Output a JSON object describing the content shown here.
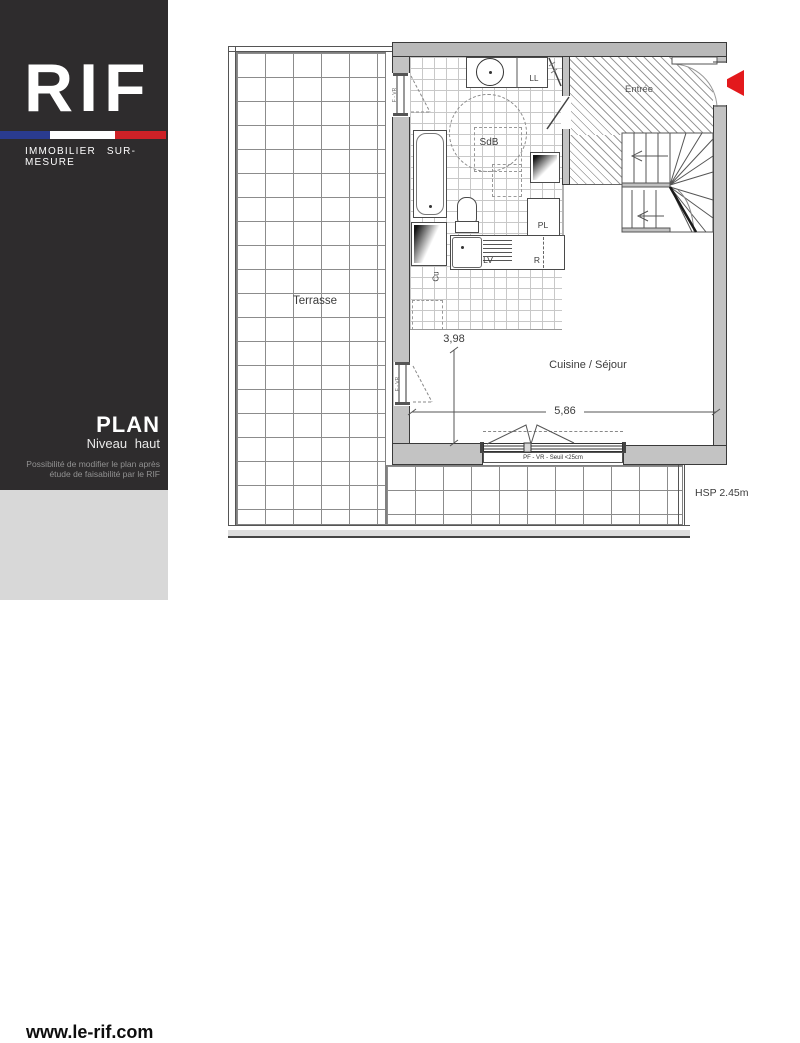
{
  "sidebar": {
    "logo": "RIF",
    "tagline": "IMMOBILIER  SUR-MESURE",
    "plan_title": "PLAN",
    "plan_subtitle": "Niveau  haut",
    "note_line1": "Possibilité de modifier le plan après",
    "note_line2": "étude de faisabilité par le RIF",
    "website": "www.le-rif.com",
    "colors": {
      "bg": "#2e2c2d",
      "footer_bg": "#d8d8d8",
      "flag_blue": "#2a3b8f",
      "flag_white": "#ffffff",
      "flag_red": "#cd2127"
    }
  },
  "plan": {
    "rooms": {
      "terrace": "Terrasse",
      "entry": "Entrée",
      "bathroom": "SdB",
      "living": "Cuisine / Séjour"
    },
    "labels": {
      "washing_machine": "LL",
      "closet": "PL",
      "dishwasher": "LV",
      "fridge": "R",
      "kitchen_unit": "Cu"
    },
    "dimensions": {
      "dim_vertical": "3,98",
      "dim_horizontal": "5,86",
      "ceiling_height": "HSP 2.45m"
    },
    "window_label": "PF - VR - Seuil <25cm",
    "window_side_label": "F - VR",
    "arrow_color": "#e3191c"
  }
}
